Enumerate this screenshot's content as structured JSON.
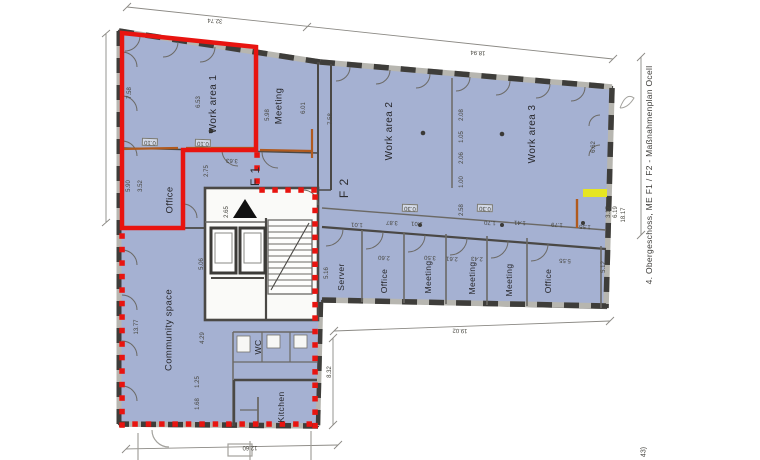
{
  "colors": {
    "room": "#a5b1d2",
    "wall": "#4a4845",
    "line": "#6b6965",
    "dimline": "#8b8984",
    "red": "#e81410",
    "orange": "#b05a1e",
    "yellow": "#e9e818",
    "text": "#3a3936"
  },
  "side_note": {
    "text": "4. Obergeschoss, ME F1 / F2 - Maßnahmenplan Ocell"
  },
  "corner_note": {
    "text": "43)"
  },
  "rooms": [
    {
      "label": "Work area 1",
      "x": 214,
      "y": 104,
      "rot": -90,
      "fs": 10
    },
    {
      "label": "Meeting",
      "x": 279,
      "y": 106,
      "rot": -90,
      "fs": 9.5
    },
    {
      "label": "Office",
      "x": 170,
      "y": 200,
      "rot": -90,
      "fs": 9.5
    },
    {
      "label": "Work area 2",
      "x": 390,
      "y": 131,
      "rot": -90,
      "fs": 10
    },
    {
      "label": "Work area 3",
      "x": 533,
      "y": 134,
      "rot": -90,
      "fs": 10
    },
    {
      "label": "Server",
      "x": 341,
      "y": 277,
      "rot": -90,
      "fs": 8.5
    },
    {
      "label": "Office",
      "x": 384,
      "y": 281,
      "rot": -90,
      "fs": 8.5
    },
    {
      "label": "Meeting",
      "x": 428,
      "y": 277,
      "rot": -90,
      "fs": 8.5
    },
    {
      "label": "Meeting",
      "x": 472,
      "y": 278,
      "rot": -90,
      "fs": 8.5
    },
    {
      "label": "Meeting",
      "x": 509,
      "y": 280,
      "rot": -90,
      "fs": 8.5
    },
    {
      "label": "Office",
      "x": 548,
      "y": 281,
      "rot": -90,
      "fs": 8.5
    },
    {
      "label": "Community space",
      "x": 169,
      "y": 330,
      "rot": -90,
      "fs": 9.5
    },
    {
      "label": "WC",
      "x": 258,
      "y": 347,
      "rot": -90,
      "fs": 8.5
    },
    {
      "label": "Kitchen",
      "x": 281,
      "y": 407,
      "rot": -90,
      "fs": 8.5
    }
  ],
  "zones": [
    {
      "label": "F 1",
      "x": 255,
      "y": 176,
      "rot": -90,
      "fs": 12
    },
    {
      "label": "F 2",
      "x": 344,
      "y": 188,
      "rot": -90,
      "fs": 12
    }
  ],
  "dimensions": [
    {
      "t": "32.74",
      "x": 215,
      "y": 20,
      "rot": 184
    },
    {
      "t": "18.94",
      "x": 478,
      "y": 52,
      "rot": 184
    },
    {
      "t": "19.02",
      "x": 460,
      "y": 330,
      "rot": 182
    },
    {
      "t": "12.60",
      "x": 250,
      "y": 447,
      "rot": 180
    },
    {
      "t": "13.77",
      "x": 137,
      "y": 327,
      "rot": -90
    },
    {
      "t": "7.58",
      "x": 130,
      "y": 93,
      "rot": -90
    },
    {
      "t": "6.53",
      "x": 199,
      "y": 102,
      "rot": -90
    },
    {
      "t": "5.98",
      "x": 268,
      "y": 115,
      "rot": -90
    },
    {
      "t": "6.01",
      "x": 304,
      "y": 108,
      "rot": -90
    },
    {
      "t": "7.58",
      "x": 331,
      "y": 119,
      "rot": -90
    },
    {
      "t": "5.90",
      "x": 129,
      "y": 186,
      "rot": -90
    },
    {
      "t": "3.52",
      "x": 141,
      "y": 186,
      "rot": -90
    },
    {
      "t": "2.75",
      "x": 207,
      "y": 171,
      "rot": -90
    },
    {
      "t": "3.63",
      "x": 232,
      "y": 160,
      "rot": 182
    },
    {
      "t": "2.65",
      "x": 227,
      "y": 212,
      "rot": -90
    },
    {
      "t": "5.16",
      "x": 327,
      "y": 273,
      "rot": -90
    },
    {
      "t": "2.60",
      "x": 384,
      "y": 257,
      "rot": 182
    },
    {
      "t": "3.50",
      "x": 430,
      "y": 257,
      "rot": 182
    },
    {
      "t": "2.61",
      "x": 452,
      "y": 258,
      "rot": 182
    },
    {
      "t": "2.43",
      "x": 477,
      "y": 258,
      "rot": 182
    },
    {
      "t": "5.55",
      "x": 565,
      "y": 260,
      "rot": 182
    },
    {
      "t": "5.12",
      "x": 604,
      "y": 267,
      "rot": -90
    },
    {
      "t": "6.62",
      "x": 594,
      "y": 147,
      "rot": -90
    },
    {
      "t": "3.17",
      "x": 609,
      "y": 212,
      "rot": -90
    },
    {
      "t": "6.19",
      "x": 616,
      "y": 212,
      "rot": -90
    },
    {
      "t": "18.17",
      "x": 624,
      "y": 215,
      "rot": -90
    },
    {
      "t": "8.32",
      "x": 330,
      "y": 372,
      "rot": -90
    },
    {
      "t": "5.06",
      "x": 202,
      "y": 264,
      "rot": -90
    },
    {
      "t": "4.29",
      "x": 203,
      "y": 338,
      "rot": -90
    },
    {
      "t": "1.25",
      "x": 198,
      "y": 382,
      "rot": -90
    },
    {
      "t": "1.68",
      "x": 198,
      "y": 404,
      "rot": -90
    },
    {
      "t": "2.08",
      "x": 462,
      "y": 115,
      "rot": -90
    },
    {
      "t": "1.05",
      "x": 462,
      "y": 137,
      "rot": -90
    },
    {
      "t": "2.06",
      "x": 462,
      "y": 158,
      "rot": -90
    },
    {
      "t": "1.00",
      "x": 462,
      "y": 182,
      "rot": -90
    },
    {
      "t": "2.58",
      "x": 462,
      "y": 210,
      "rot": -90
    },
    {
      "t": "1.01",
      "x": 357,
      "y": 224,
      "rot": 182
    },
    {
      "t": "3.87",
      "x": 392,
      "y": 222,
      "rot": 182
    },
    {
      "t": "1.01",
      "x": 417,
      "y": 223,
      "rot": 182
    },
    {
      "t": "1.70",
      "x": 490,
      "y": 222,
      "rot": 182
    },
    {
      "t": "1.41",
      "x": 520,
      "y": 222,
      "rot": 182
    },
    {
      "t": "1.79",
      "x": 557,
      "y": 224,
      "rot": 182
    },
    {
      "t": "1.55",
      "x": 585,
      "y": 226,
      "rot": 182
    },
    {
      "t": "0.10",
      "x": 150,
      "y": 142,
      "rot": 182,
      "boxed": true
    },
    {
      "t": "0.10",
      "x": 203,
      "y": 143,
      "rot": 182,
      "boxed": true
    },
    {
      "t": "0.30",
      "x": 410,
      "y": 208,
      "rot": 182,
      "boxed": true
    },
    {
      "t": "0.30",
      "x": 485,
      "y": 208,
      "rot": 182,
      "boxed": true
    }
  ]
}
